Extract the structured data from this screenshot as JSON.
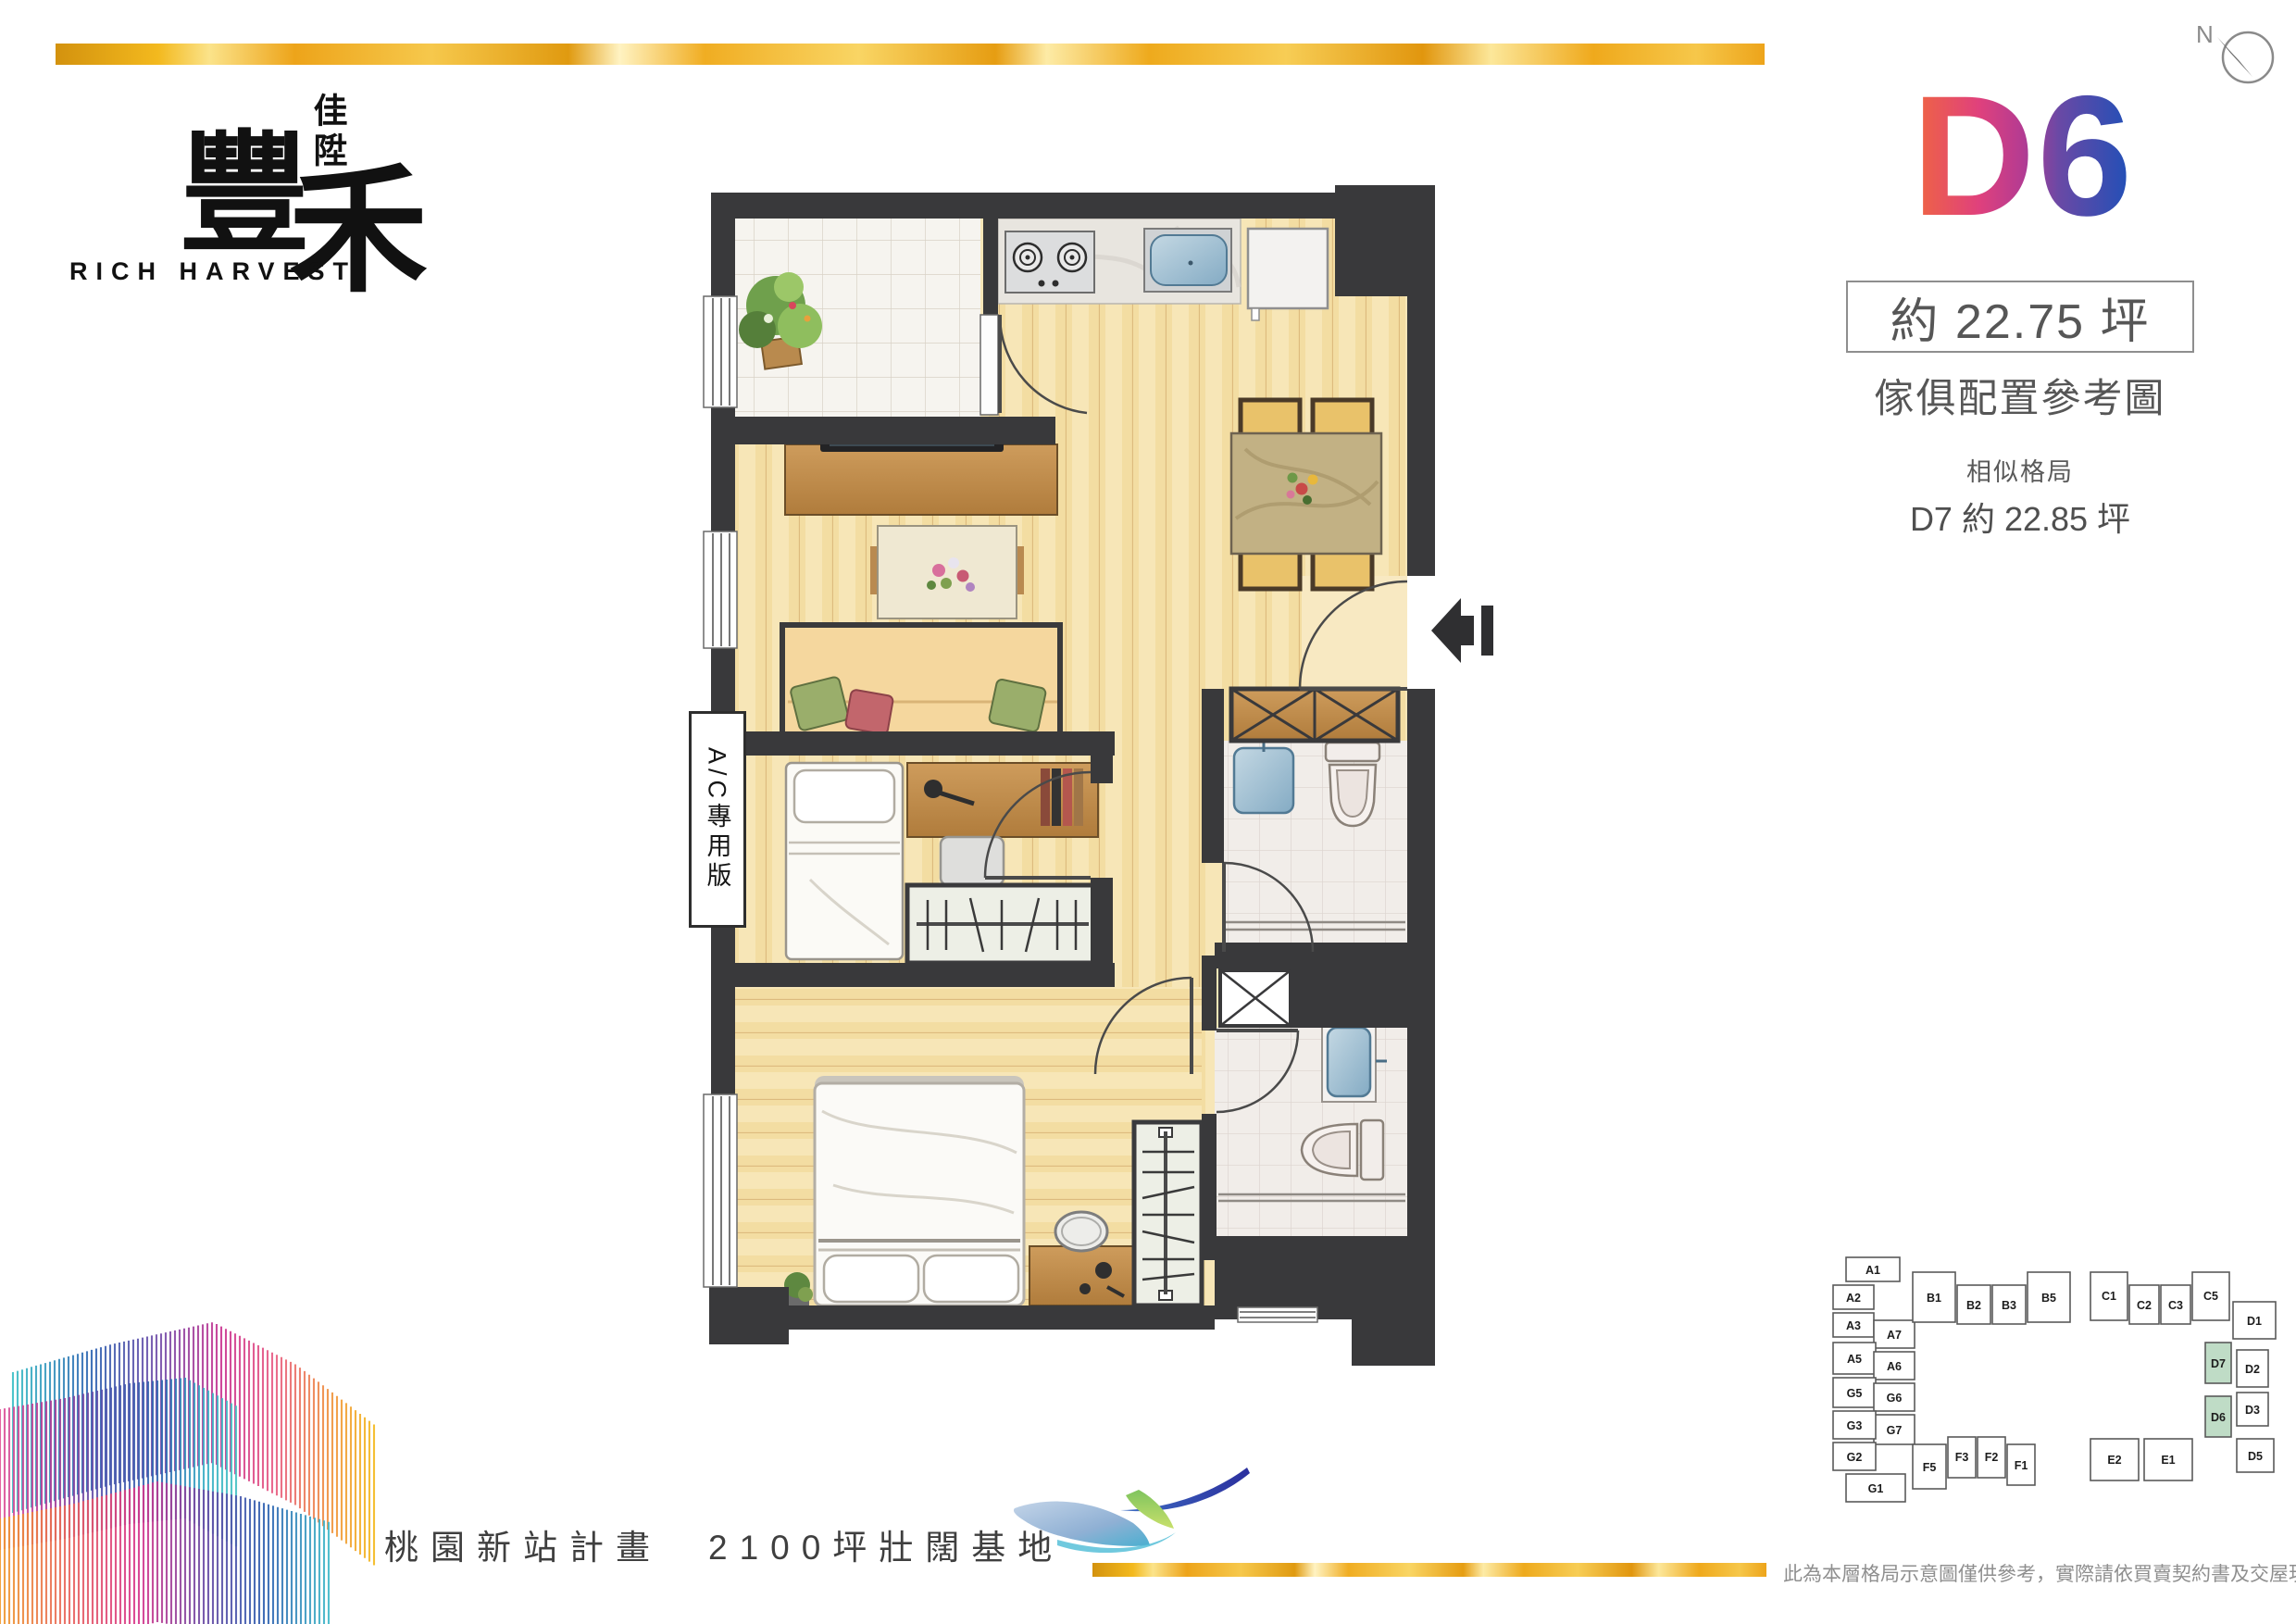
{
  "brand": {
    "logo_sub": "佳陞",
    "logo_main_1": "豐",
    "logo_main_2": "禾",
    "logo_en": "RICH HARVEST"
  },
  "compass": {
    "label": "N"
  },
  "unit": {
    "code": "D6",
    "area": "約 22.75 坪",
    "subtitle": "傢俱配置參考圖",
    "similar_title": "相似格局",
    "similar_detail": "D7 約 22.85 坪"
  },
  "floorplan": {
    "ac_label": "A/C專用版"
  },
  "footer": {
    "slogan": "桃園新站計畫　2100坪壯闊基地",
    "disclaimer": "此為本層格局示意圖僅供參考，實際請依買賣契約書及交屋現況為準。"
  },
  "keyplan": {
    "units": [
      "A1",
      "A2",
      "A3",
      "A7",
      "A5",
      "A6",
      "G5",
      "G6",
      "G7",
      "G3",
      "G2",
      "G1",
      "B1",
      "B2",
      "B3",
      "B5",
      "C1",
      "C2",
      "C3",
      "C5",
      "D1",
      "D7",
      "D2",
      "D6",
      "D3",
      "D5",
      "E2",
      "E1",
      "F5",
      "F3",
      "F2",
      "F1"
    ],
    "highlighted": [
      "D7",
      "D6"
    ]
  },
  "colors": {
    "gold": "#EDA41A",
    "keyplan_highlight": "#BFDCC6",
    "d6_stop1": "#F0673F",
    "d6_stop2": "#E0417C",
    "d6_stop3": "#B43B92",
    "d6_stop4": "#6A49A5",
    "d6_stop5": "#1D50B8",
    "wall": "#39393B"
  }
}
